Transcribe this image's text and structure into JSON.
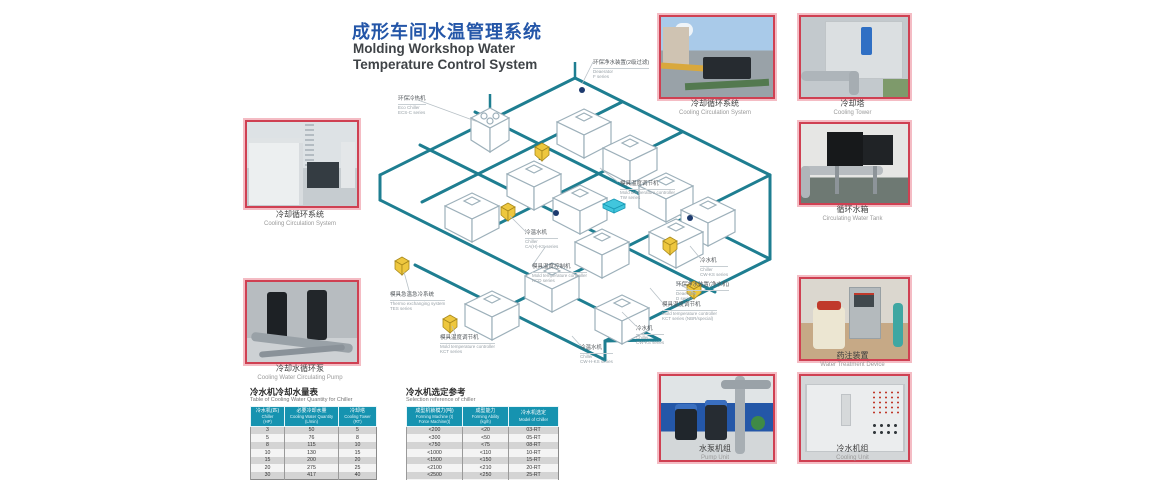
{
  "page": {
    "title_zh": "成形车间水温管理系统",
    "title_en_line1": "Molding Workshop Water",
    "title_en_line2": "Temperature Control System"
  },
  "colors": {
    "title_blue": "#2456a8",
    "frame_red": "#cf4052",
    "pipe_teal": "#1e7e91",
    "table_header_teal": "#1693b0",
    "unit_yellow": "#eec73e",
    "unit_cyan": "#41c6dd"
  },
  "photos": {
    "left_top": {
      "zh": "冷却循环系统",
      "en": "Cooling Circulation System"
    },
    "left_bottom": {
      "zh": "冷却水循环泵",
      "en": "Cooling Water Circulating Pump"
    },
    "top_right_1": {
      "zh": "冷却循环系统",
      "en": "Cooling Circulation System"
    },
    "top_right_2": {
      "zh": "冷却塔",
      "en": "Cooling Tower"
    },
    "mid_right": {
      "zh": "循环水箱",
      "en": "Circulating Water Tank"
    },
    "low_right": {
      "zh": "药注装置",
      "en": "Water Treatment Device"
    },
    "bottom_right_1": {
      "zh": "水泵机组",
      "en": "Pump Unit"
    },
    "bottom_right_2": {
      "zh": "冷水机组",
      "en": "Cooling Unit"
    }
  },
  "diagram": {
    "labels": [
      {
        "zh": "环保净水装置(2级过滤)",
        "en": "Deaerator",
        "series": "F series"
      },
      {
        "zh": "环保冷热机",
        "en": "Eco Chiller",
        "series": "ECS-C series"
      },
      {
        "zh": "模具温度调节机",
        "en": "Mold temperature controller",
        "series": "TW series"
      },
      {
        "zh": "冷温水机",
        "en": "Chiller",
        "series": "CA(H)-KS series"
      },
      {
        "zh": "模具温度控制机",
        "en": "Mold temperature controller",
        "series": "KCD series"
      },
      {
        "zh": "模具急温急冷系统",
        "en": "Thermo exchanging system",
        "series": "TES series"
      },
      {
        "zh": "模具温度调节机",
        "en": "Mold temperature controller",
        "series": "KCT series"
      },
      {
        "zh": "冷水机",
        "en": "Chiller",
        "series": "CW-KS series"
      },
      {
        "zh": "环保净水装置(净水机)",
        "en": "Deaerator",
        "series": "D series"
      },
      {
        "zh": "模具温度调节机",
        "en": "Mold temperature controller",
        "series": "KCT series (NBR/special)"
      },
      {
        "zh": "冷水机",
        "en": "Chiller",
        "series": "CW-KS series"
      },
      {
        "zh": "冷温水机",
        "en": "Chiller",
        "series": "CW-H-KS series"
      }
    ]
  },
  "tables": {
    "left": {
      "title_zh": "冷水机冷却水量表",
      "title_en": "Table of Cooling Water Quantity for Chiller",
      "headers": [
        [
          "冷水机(匹)",
          "Chiller",
          "(HP)"
        ],
        [
          "必要冷却水量",
          "Cooling Water Quantity",
          "(L/min)"
        ],
        [
          "冷却塔",
          "Cooling Tower",
          "(RT)"
        ]
      ],
      "rows": [
        [
          "3",
          "50",
          "5"
        ],
        [
          "5",
          "76",
          "8"
        ],
        [
          "8",
          "115",
          "10"
        ],
        [
          "10",
          "130",
          "15"
        ],
        [
          "15",
          "200",
          "20"
        ],
        [
          "20",
          "275",
          "25"
        ],
        [
          "30",
          "417",
          "40"
        ]
      ]
    },
    "right": {
      "title_zh": "冷水机选定参考",
      "title_en": "Selection reference of chiller",
      "headers": [
        [
          "成型机锁模力(吨)",
          "Forming Machine (t)",
          "Force Machine(t)"
        ],
        [
          "成型能力",
          "Forming Ability",
          "(kg/h)"
        ],
        [
          "冷水机选定",
          "Model of Chiller",
          ""
        ]
      ],
      "rows": [
        [
          "<200",
          "<20",
          "03-RT"
        ],
        [
          "<300",
          "<50",
          "05-RT"
        ],
        [
          "<750",
          "<75",
          "08-RT"
        ],
        [
          "<1000",
          "<110",
          "10-RT"
        ],
        [
          "<1500",
          "<150",
          "15-RT"
        ],
        [
          "<2100",
          "<210",
          "20-RT"
        ],
        [
          "<2500",
          "<250",
          "25-RT"
        ],
        [
          "<4000",
          "<400",
          "30-RT"
        ]
      ]
    }
  }
}
